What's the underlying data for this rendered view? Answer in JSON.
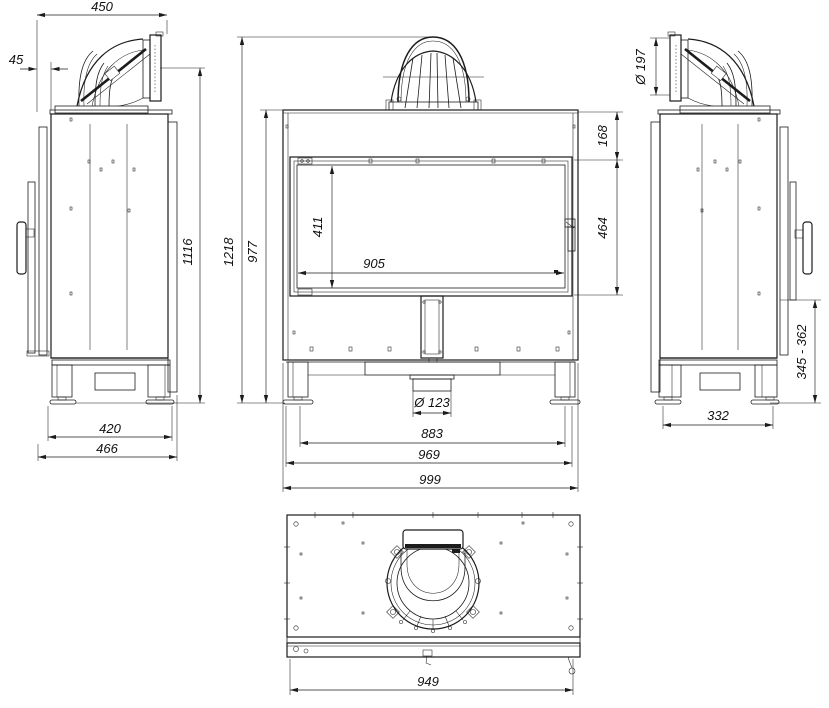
{
  "colors": {
    "background": "#ffffff",
    "line": "#1c1c1c"
  },
  "views": {
    "left_side": {
      "dims": {
        "depth_with_flue": "450",
        "flue_front_offset": "45",
        "flue_axis_height": "1116",
        "feet_spacing": "420",
        "total_depth": "466"
      }
    },
    "front": {
      "dims": {
        "total_height": "1218",
        "body_height": "977",
        "top_to_glass": "168",
        "door_glass_height": "464",
        "glass_view_height": "411",
        "glass_view_width": "905",
        "air_inlet_diameter": "Ø 123",
        "feet_spacing": "883",
        "inner_width": "969",
        "total_width": "999"
      }
    },
    "right_side": {
      "dims": {
        "flue_diameter": "Ø 197",
        "plinth_height_range": "345 - 362",
        "feet_spacing": "332"
      }
    },
    "top": {
      "dims": {
        "front_panel_width": "949"
      }
    }
  }
}
